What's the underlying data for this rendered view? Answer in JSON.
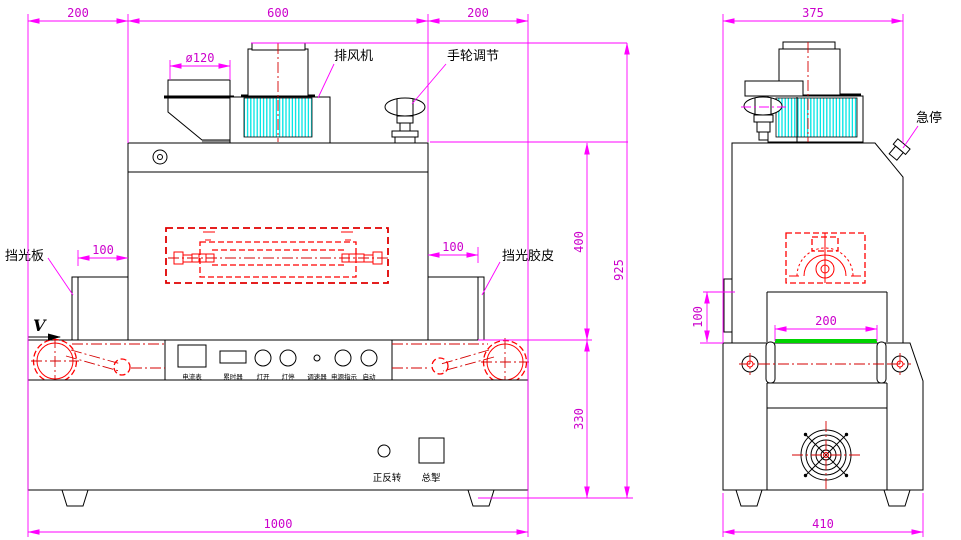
{
  "front_view": {
    "dimensions": {
      "overhang_left": "200",
      "body_width": "600",
      "overhang_right": "200",
      "duct_diameter": "ø120",
      "shield_inset_left": "100",
      "shield_inset_right": "100",
      "body_height": "400",
      "total_height": "925",
      "base_height": "330",
      "total_length": "1000"
    },
    "labels": {
      "exhaust_fan": "排风机",
      "handwheel_adjust": "手轮调节",
      "light_shield_plate": "挡光板",
      "light_shield_rubber": "挡光胶皮",
      "belt_direction": "V"
    },
    "control_panel": {
      "ammeter": "电流表",
      "hour_meter": "累时器",
      "lamp_on": "灯开",
      "lamp_off": "灯停",
      "speed_regulator": "调速器",
      "power_indicator": "电源指示",
      "start": "启动",
      "fwd_rev": "正反转",
      "main_switch": "总掣"
    }
  },
  "side_view": {
    "dimensions": {
      "depth": "375",
      "opening_height": "100",
      "belt_width": "200",
      "base_depth": "410"
    },
    "labels": {
      "emergency_stop": "急停"
    }
  },
  "colors": {
    "dimension": "#ff00ff",
    "outline": "#000000",
    "hatch": "#00ffff",
    "detail_red": "#ff0000",
    "belt_green": "#00d400"
  }
}
